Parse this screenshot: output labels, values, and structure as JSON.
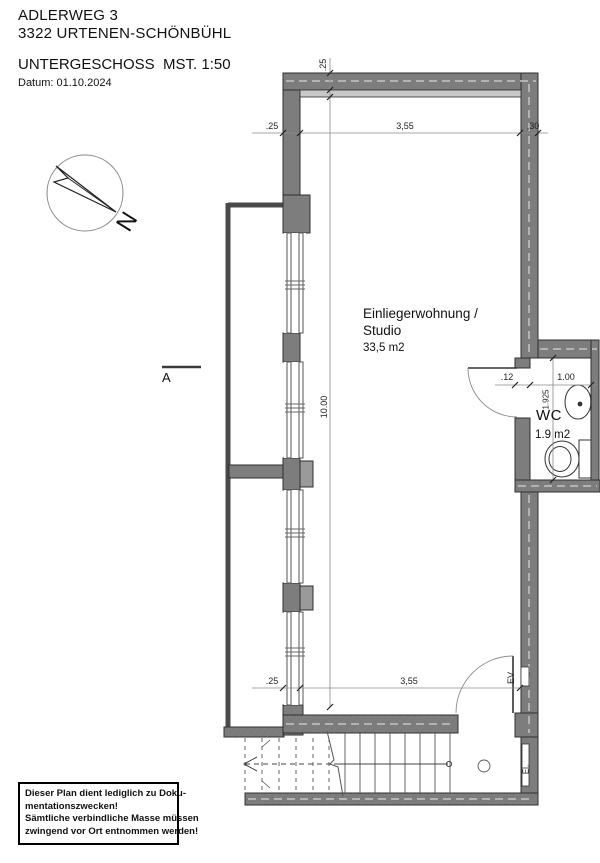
{
  "header": {
    "address_line1": "ADLERWEG 3",
    "address_line2": "3322 URTENEN-SCHÖNBÜHL",
    "plan_title": "UNTERGESCHOSS  MST. 1:50",
    "date": "Datum: 01.10.2024"
  },
  "compass": {
    "north_label": "N"
  },
  "section": {
    "label": "A"
  },
  "rooms": {
    "studio": {
      "line1": "Einliegerwohnung /",
      "line2": "Studio",
      "area": "33,5 m2"
    },
    "wc": {
      "name": "WC",
      "area": "1.9 m2"
    }
  },
  "dims": {
    "wall_top": ".25",
    "top_left": ".25",
    "top_width": "3,55",
    "top_right": ",30",
    "room_depth": "10.00",
    "bottom_left": ".25",
    "bottom_width": "3,55",
    "wc_gap": ".12",
    "wc_width": "1.00",
    "wc_depth": "1.925"
  },
  "labels": {
    "ev": "EV",
    "el": "El."
  },
  "note": {
    "lines": [
      "Dieser Plan dient lediglich zu Doku-",
      "mentationszwecken!",
      "Sämtliche verbindliche Masse müssen",
      "zwingend vor Ort entnommen werden!"
    ]
  },
  "colors": {
    "wall_fill": "#7d7d7d",
    "wall_outline": "#2f2f2f",
    "lightwell_line": "#4a4a4a",
    "plaster": "#c8c8c8",
    "thin_line": "#555555",
    "dim_line": "#8a8a8a"
  }
}
